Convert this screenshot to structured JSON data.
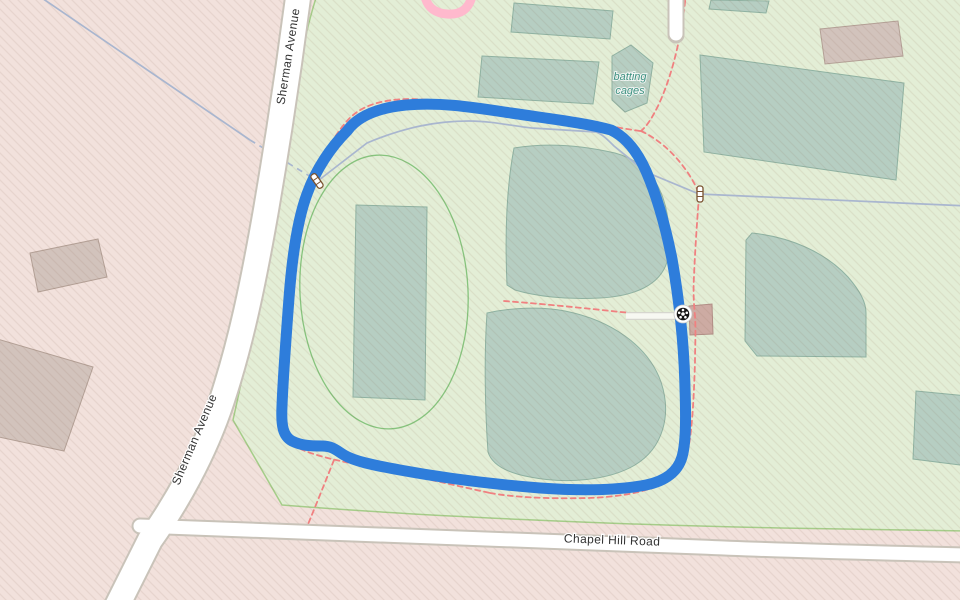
{
  "map": {
    "labels": {
      "sherman_avenue": "Sherman Avenue",
      "chapel_hill_road": "Chapel Hill Road",
      "batting_cages": {
        "line1": "batting",
        "line2": "cages"
      }
    },
    "icons": [
      "gate-icon",
      "gate-icon",
      "soccer-ball-icon"
    ],
    "colors": {
      "route": "#2e7ddb",
      "park": "#e3eed6",
      "residential": "#f2e1dc",
      "pitch": "#b6cec2",
      "pitch_outline": "#8fb2a2",
      "building": "#d2c3bc",
      "building_outline": "#b3a096",
      "road_fill": "#ffffff",
      "road_casing": "#c9c3b9",
      "path": "#f08080",
      "water": "#a9b6cf",
      "track_pink": "#ffb9cd",
      "park_outline": "#a5cd89",
      "label": "#333333",
      "leisure_label": "#3d9181"
    }
  }
}
